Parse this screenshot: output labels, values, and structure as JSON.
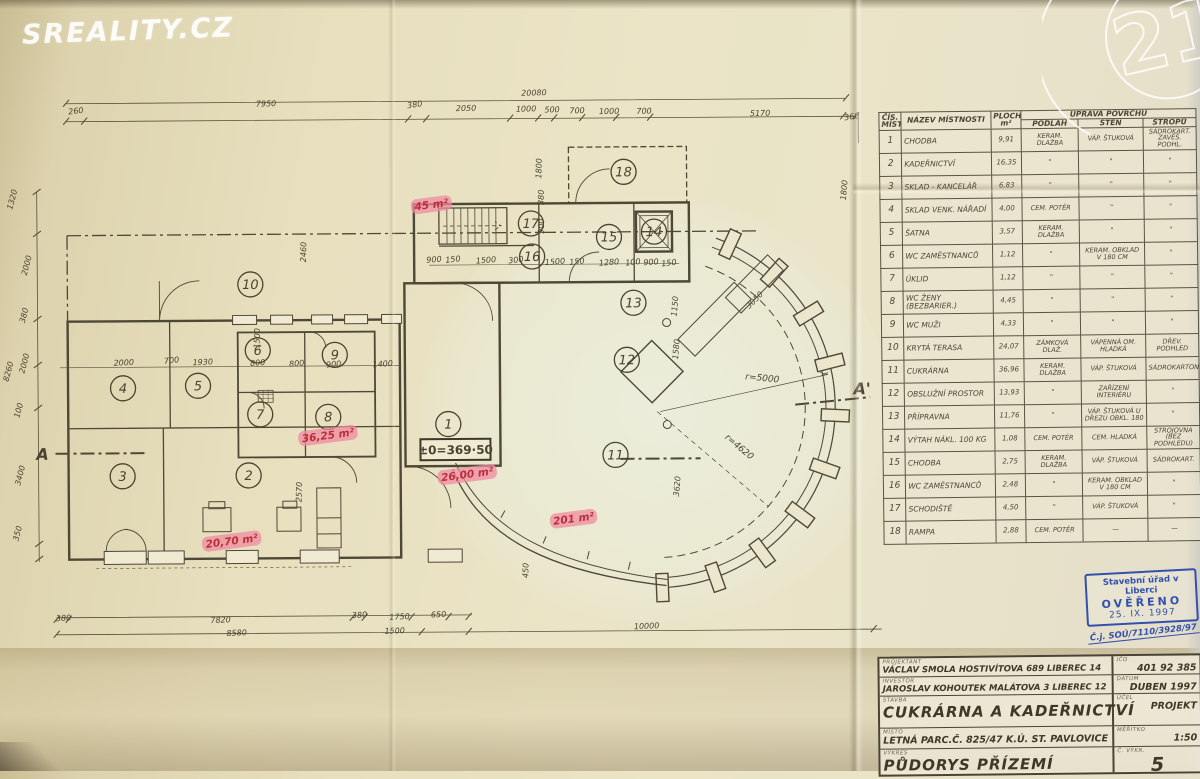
{
  "watermarks": {
    "sreality": "SREALITY.CZ",
    "c21": "21"
  },
  "stamp": {
    "line1": "Stavební úřad v Liberci",
    "line2": "OVĚŘENO",
    "line3": "25. IX. 1997",
    "cj": "Č.j. SOÚ/7110/3928/97"
  },
  "room_table": {
    "headers": {
      "col_num": "ČÍS. MÍST.",
      "col_name": "NÁZEV MÍSTNOSTI",
      "col_area_1": "PLOCHA",
      "col_area_2": "m²",
      "col_surface": "ÚPRAVA POVRCHU",
      "col_floor": "PODLAH",
      "col_wall": "STĚN",
      "col_ceiling": "STROPŮ"
    },
    "rows": [
      {
        "num": "1",
        "name": "CHODBA",
        "area": "9,91",
        "floor": "KERAM. DLAŽBA",
        "wall": "VÁP. ŠTUKOVÁ",
        "ceiling": "SÁDROKART. ZAVĚŠ. PODHL."
      },
      {
        "num": "2",
        "name": "KADEŘNICTVÍ",
        "area": "16,35",
        "floor": "\"",
        "wall": "\"",
        "ceiling": "\""
      },
      {
        "num": "3",
        "name": "SKLAD - KANCELÁŘ",
        "area": "6,83",
        "floor": "\"",
        "wall": "\"",
        "ceiling": "\""
      },
      {
        "num": "4",
        "name": "SKLAD VENK. NÁŘADÍ",
        "area": "4,00",
        "floor": "CEM. POTĚR",
        "wall": "\"",
        "ceiling": "\""
      },
      {
        "num": "5",
        "name": "ŠATNA",
        "area": "3,57",
        "floor": "KERAM. DLAŽBA",
        "wall": "\"",
        "ceiling": "\""
      },
      {
        "num": "6",
        "name": "WC ZAMĚSTNANCŮ",
        "area": "1,12",
        "floor": "\"",
        "wall": "KERAM. OBKLAD V 180 CM",
        "ceiling": "\""
      },
      {
        "num": "7",
        "name": "ÚKLID",
        "area": "1,12",
        "floor": "\"",
        "wall": "\"",
        "ceiling": "\""
      },
      {
        "num": "8",
        "name": "WC ŽENY (BEZBARIER.)",
        "area": "4,45",
        "floor": "\"",
        "wall": "\"",
        "ceiling": "\""
      },
      {
        "num": "9",
        "name": "WC MUŽI",
        "area": "4,33",
        "floor": "\"",
        "wall": "\"",
        "ceiling": "\""
      },
      {
        "num": "10",
        "name": "KRYTÁ TERASA",
        "area": "24,07",
        "floor": "ZÁMKOVÁ DLAŽ.",
        "wall": "VÁPENNÁ OM. HLADKÁ",
        "ceiling": "DŘEV. PODHLED"
      },
      {
        "num": "11",
        "name": "CUKRÁRNA",
        "area": "36,96",
        "floor": "KERAM. DLAŽBA",
        "wall": "VÁP. ŠTUKOVÁ",
        "ceiling": "SÁDROKARTON"
      },
      {
        "num": "12",
        "name": "OBSLUŽNÍ PROSTOR",
        "area": "13,93",
        "floor": "\"",
        "wall": "ZAŘÍZENÍ INTERIÉRU",
        "ceiling": "\""
      },
      {
        "num": "13",
        "name": "PŘÍPRAVNA",
        "area": "11,76",
        "floor": "\"",
        "wall": "VÁP. ŠTUKOVÁ U DŘEZU OBKL. 180",
        "ceiling": "\""
      },
      {
        "num": "14",
        "name": "VÝTAH NÁKL. 100 KG",
        "area": "1,08",
        "floor": "CEM. POTĚR",
        "wall": "CEM. HLADKÁ",
        "ceiling": "STROJOVNA (BEZ PODHLEDU)"
      },
      {
        "num": "15",
        "name": "CHODBA",
        "area": "2,75",
        "floor": "KERAM. DLAŽBA",
        "wall": "VÁP. ŠTUKOVÁ",
        "ceiling": "SÁDROKART."
      },
      {
        "num": "16",
        "name": "WC ZAMĚSTNANCŮ",
        "area": "2,48",
        "floor": "\"",
        "wall": "KERAM. OBKLAD V 180 CM",
        "ceiling": "\""
      },
      {
        "num": "17",
        "name": "SCHODIŠTĚ",
        "area": "4,50",
        "floor": "\"",
        "wall": "VÁP. ŠTUKOVÁ",
        "ceiling": "\""
      },
      {
        "num": "18",
        "name": "RAMPA",
        "area": "2,88",
        "floor": "CEM. POTĚR",
        "wall": "—",
        "ceiling": "—"
      }
    ]
  },
  "title_block": {
    "left_rows": [
      {
        "label": "PROJEKTANT",
        "value": "VÁCLAV SMOLA HOSTIVÍTOVA 689 LIBEREC 14",
        "size": "s"
      },
      {
        "label": "INVESTOR",
        "value": "JAROSLAV KOHOUTEK MALÁTOVA 3 LIBEREC 12",
        "size": "s"
      },
      {
        "label": "STAVBA",
        "value": "CUKRÁRNA A KADEŘNICTVÍ",
        "size": "l"
      },
      {
        "label": "MÍSTO",
        "value": "LETNÁ PARC.Č. 825/47 K.Ú. ST. PAVLOVICE",
        "size": "m"
      },
      {
        "label": "VÝKRES",
        "value": "PŮDORYS PŘÍZEMÍ",
        "size": "l"
      }
    ],
    "right_rows": [
      {
        "label": "IČO",
        "value": "401 92 385",
        "big": false
      },
      {
        "label": "DATUM",
        "value": "DUBEN 1997",
        "big": false
      },
      {
        "label": "ÚČEL",
        "value": "PROJEKT",
        "big": false
      },
      {
        "label": "MĚŘÍTKO",
        "value": "1:50",
        "big": false
      },
      {
        "label": "Č. VÝKR.",
        "value": "5",
        "big": true
      }
    ]
  },
  "plan": {
    "level_mark": "±0=369·50",
    "room_markers": [
      {
        "n": "1",
        "x": 448,
        "y": 423
      },
      {
        "n": "2",
        "x": 248,
        "y": 473
      },
      {
        "n": "3",
        "x": 122,
        "y": 473
      },
      {
        "n": "4",
        "x": 123,
        "y": 385
      },
      {
        "n": "5",
        "x": 198,
        "y": 383
      },
      {
        "n": "6",
        "x": 258,
        "y": 348
      },
      {
        "n": "7",
        "x": 260,
        "y": 412
      },
      {
        "n": "8",
        "x": 328,
        "y": 415
      },
      {
        "n": "9",
        "x": 335,
        "y": 353
      },
      {
        "n": "10",
        "x": 251,
        "y": 282
      },
      {
        "n": "11",
        "x": 615,
        "y": 455
      },
      {
        "n": "12",
        "x": 627,
        "y": 360
      },
      {
        "n": "13",
        "x": 634,
        "y": 303
      },
      {
        "n": "14",
        "x": 655,
        "y": 232
      },
      {
        "n": "15",
        "x": 610,
        "y": 237
      },
      {
        "n": "16",
        "x": 533,
        "y": 256
      },
      {
        "n": "17",
        "x": 532,
        "y": 223
      },
      {
        "n": "18",
        "x": 625,
        "y": 172
      }
    ],
    "red_annotations": [
      {
        "t": "45 m²",
        "x": 433,
        "y": 207
      },
      {
        "t": "36,25 m²",
        "x": 328,
        "y": 437
      },
      {
        "t": "20,70 m²",
        "x": 231,
        "y": 542
      },
      {
        "t": "26,00 m²",
        "x": 467,
        "y": 477
      },
      {
        "t": "201 m²",
        "x": 573,
        "y": 522
      }
    ],
    "dim_labels": [
      {
        "t": "20080",
        "x": 536,
        "y": 95,
        "r": -1
      },
      {
        "t": "260",
        "x": 78,
        "y": 110,
        "r": -6
      },
      {
        "t": "7950",
        "x": 268,
        "y": 104,
        "r": -1
      },
      {
        "t": "380",
        "x": 417,
        "y": 106,
        "r": -8
      },
      {
        "t": "2050",
        "x": 468,
        "y": 110,
        "r": -1
      },
      {
        "t": "1000",
        "x": 528,
        "y": 111,
        "r": -1
      },
      {
        "t": "500",
        "x": 554,
        "y": 112,
        "r": -1
      },
      {
        "t": "700",
        "x": 579,
        "y": 113,
        "r": -1
      },
      {
        "t": "1000",
        "x": 611,
        "y": 114,
        "r": -1
      },
      {
        "t": "700",
        "x": 646,
        "y": 114,
        "r": -1
      },
      {
        "t": "5170",
        "x": 762,
        "y": 117,
        "r": -1
      },
      {
        "t": "360",
        "x": 854,
        "y": 121,
        "r": -8
      },
      {
        "t": "1320",
        "x": 16,
        "y": 196,
        "r": -75
      },
      {
        "t": "2000",
        "x": 30,
        "y": 262,
        "r": -75
      },
      {
        "t": "380",
        "x": 27,
        "y": 312,
        "r": -75
      },
      {
        "t": "2000",
        "x": 27,
        "y": 360,
        "r": -75
      },
      {
        "t": "8260",
        "x": 11,
        "y": 368,
        "r": -75
      },
      {
        "t": "100",
        "x": 21,
        "y": 407,
        "r": -75
      },
      {
        "t": "3400",
        "x": 22,
        "y": 472,
        "r": -75
      },
      {
        "t": "350",
        "x": 19,
        "y": 530,
        "r": -75
      },
      {
        "t": "380",
        "x": 62,
        "y": 617,
        "r": -3
      },
      {
        "t": "7820",
        "x": 219,
        "y": 620,
        "r": -2
      },
      {
        "t": "380",
        "x": 358,
        "y": 616,
        "r": -3
      },
      {
        "t": "1750",
        "x": 398,
        "y": 618,
        "r": -2
      },
      {
        "t": "650",
        "x": 437,
        "y": 616,
        "r": -2
      },
      {
        "t": "8580",
        "x": 235,
        "y": 633,
        "r": -2
      },
      {
        "t": "1500",
        "x": 393,
        "y": 632,
        "r": -2
      },
      {
        "t": "10000",
        "x": 645,
        "y": 629,
        "r": -2
      },
      {
        "t": "2000",
        "x": 124,
        "y": 362,
        "r": -2
      },
      {
        "t": "700",
        "x": 172,
        "y": 360,
        "r": -6
      },
      {
        "t": "1930",
        "x": 203,
        "y": 362,
        "r": -2
      },
      {
        "t": "800",
        "x": 258,
        "y": 363,
        "r": -4
      },
      {
        "t": "800",
        "x": 297,
        "y": 364,
        "r": -4
      },
      {
        "t": "900",
        "x": 334,
        "y": 365,
        "r": -4
      },
      {
        "t": "1400",
        "x": 383,
        "y": 365,
        "r": -4
      },
      {
        "t": "900",
        "x": 435,
        "y": 261,
        "r": -4
      },
      {
        "t": "150",
        "x": 454,
        "y": 261,
        "r": -6
      },
      {
        "t": "1500",
        "x": 487,
        "y": 262,
        "r": -4
      },
      {
        "t": "300",
        "x": 517,
        "y": 262,
        "r": -6
      },
      {
        "t": "1500",
        "x": 556,
        "y": 264,
        "r": -4
      },
      {
        "t": "150",
        "x": 578,
        "y": 264,
        "r": -6
      },
      {
        "t": "1280",
        "x": 610,
        "y": 265,
        "r": -4
      },
      {
        "t": "100",
        "x": 634,
        "y": 265,
        "r": -6
      },
      {
        "t": "900",
        "x": 652,
        "y": 265,
        "r": -4
      },
      {
        "t": "150",
        "x": 670,
        "y": 266,
        "r": -6
      },
      {
        "t": "1800",
        "x": 543,
        "y": 168,
        "r": -88
      },
      {
        "t": "380",
        "x": 545,
        "y": 197,
        "r": -88
      },
      {
        "t": "900",
        "x": 545,
        "y": 226,
        "r": -88
      },
      {
        "t": "2460",
        "x": 307,
        "y": 250,
        "r": -88
      },
      {
        "t": "2570",
        "x": 301,
        "y": 490,
        "r": -88
      },
      {
        "t": "3620",
        "x": 679,
        "y": 487,
        "r": -85
      },
      {
        "t": "1800",
        "x": 848,
        "y": 192,
        "r": -85
      },
      {
        "t": "1150",
        "x": 678,
        "y": 307,
        "r": -85
      },
      {
        "t": "1580",
        "x": 679,
        "y": 350,
        "r": -85
      },
      {
        "t": "450",
        "x": 527,
        "y": 570,
        "r": -88
      },
      {
        "t": "3050",
        "x": 757,
        "y": 303,
        "r": -45
      },
      {
        "t": "1500",
        "x": 260,
        "y": 336,
        "r": -88
      },
      {
        "t": "r=5000",
        "x": 762,
        "y": 382,
        "r": 6,
        "c": "rad"
      },
      {
        "t": "r=4620",
        "x": 737,
        "y": 450,
        "r": 40,
        "c": "rad"
      },
      {
        "t": "A",
        "x": 42,
        "y": 456,
        "r": 0,
        "c": "section"
      },
      {
        "t": "A'",
        "x": 862,
        "y": 396,
        "r": 0,
        "c": "section"
      }
    ]
  }
}
